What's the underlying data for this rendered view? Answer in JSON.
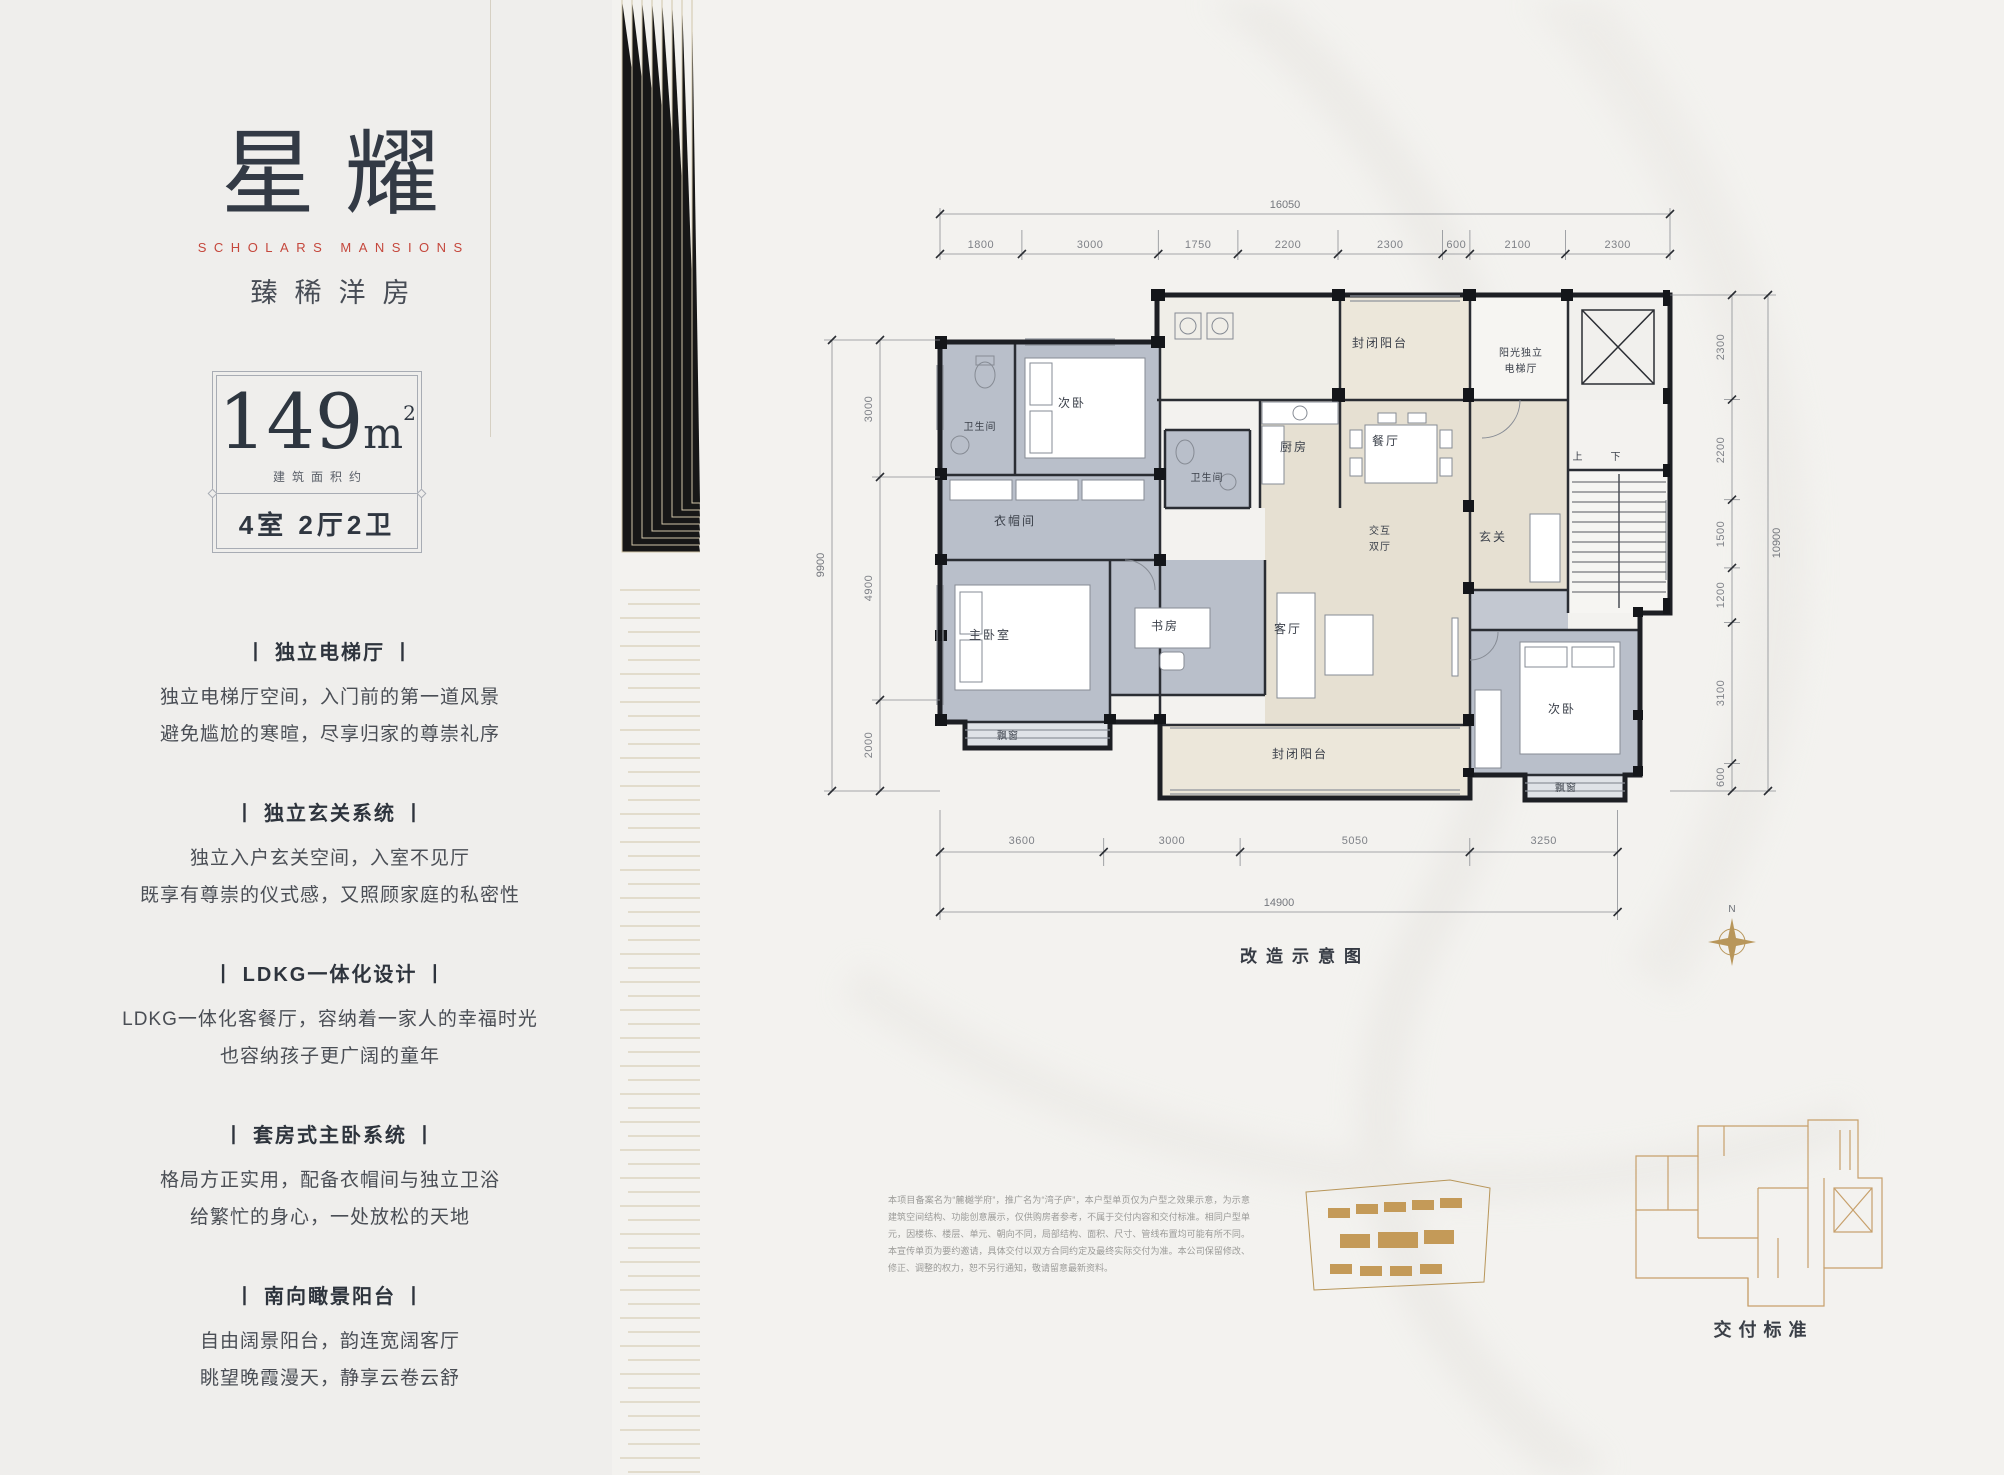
{
  "brand": {
    "logo": "星耀",
    "logo_en": "SCHOLARS MANSIONS",
    "tagline": "臻稀洋房"
  },
  "area_card": {
    "value": "149",
    "unit_base": "m",
    "unit_sup": "2",
    "note": "建筑面积约",
    "layout": "4室 2厅2卫"
  },
  "features": [
    {
      "title": "丨 独立电梯厅 丨",
      "line1": "独立电梯厅空间，入门前的第一道风景",
      "line2": "避免尴尬的寒暄，尽享归家的尊崇礼序"
    },
    {
      "title": "丨 独立玄关系统 丨",
      "line1": "独立入户玄关空间，入室不见厅",
      "line2": "既享有尊崇的仪式感，又照顾家庭的私密性"
    },
    {
      "title": "丨 LDKG一体化设计 丨",
      "line1": "LDKG一体化客餐厅，容纳着一家人的幸福时光",
      "line2": "也容纳孩子更广阔的童年"
    },
    {
      "title": "丨 套房式主卧系统 丨",
      "line1": "格局方正实用，配备衣帽间与独立卫浴",
      "line2": "给繁忙的身心，一处放松的天地"
    },
    {
      "title": "丨 南向瞰景阳台 丨",
      "line1": "自由阔景阳台，韵连宽阔客厅",
      "line2": "眺望晚霞漫天，静享云卷云舒"
    }
  ],
  "floorplan": {
    "caption": "改造示意图",
    "compass_label": "N",
    "rooms": {
      "bath": "卫生间",
      "bedroom2": "次卧",
      "cloakroom": "衣帽间",
      "master": "主卧室",
      "bay_window": "飘窗",
      "study": "书房",
      "kitchen": "厨房",
      "dining": "餐厅",
      "enclosed_balcony": "封闭阳台",
      "elevator_line1": "阳光独立",
      "elevator_line2": "电梯厅",
      "foyer": "玄关",
      "hall_line1": "交互",
      "hall_line2": "双厅",
      "living": "客厅",
      "stair_up": "上",
      "stair_down": "下"
    },
    "dims": {
      "top_total": "16050",
      "top": [
        "1800",
        "3000",
        "1750",
        "2200",
        "2300",
        "600",
        "2100",
        "2300"
      ],
      "left_total": "9900",
      "left": [
        "3000",
        "4900",
        "2000"
      ],
      "right_total": "10900",
      "right": [
        "2300",
        "2200",
        "1500",
        "1200",
        "3100",
        "600"
      ],
      "bottom": [
        "3600",
        "3000",
        "5050",
        "3250"
      ],
      "bottom_total": "14900"
    }
  },
  "footer": {
    "disclaimer": "本项目备案名为“麓樾学府”，推广名为“湾子庐”，本户型单页仅为户型之效果示意，为示意建筑空间结构、功能创意展示，仅供购房者参考，不属于交付内容和交付标准。相同户型单元，因楼栋、楼层、单元、朝向不同，局部结构、面积、尺寸、管线布置均可能有所不同。本宣传单页为要约邀请，具体交付以双方合同约定及最终实际交付为准。本公司保留修改、修正、调整的权力，恕不另行通知，敬请留意最新资料。",
    "delivery_label": "交付标准"
  },
  "colors": {
    "accent_red": "#c5473c",
    "gold": "#b8965a",
    "ink": "#333a45",
    "room_gray": "#b9bfca",
    "room_beige": "#e6e0d2",
    "wall": "#1d1f24"
  }
}
